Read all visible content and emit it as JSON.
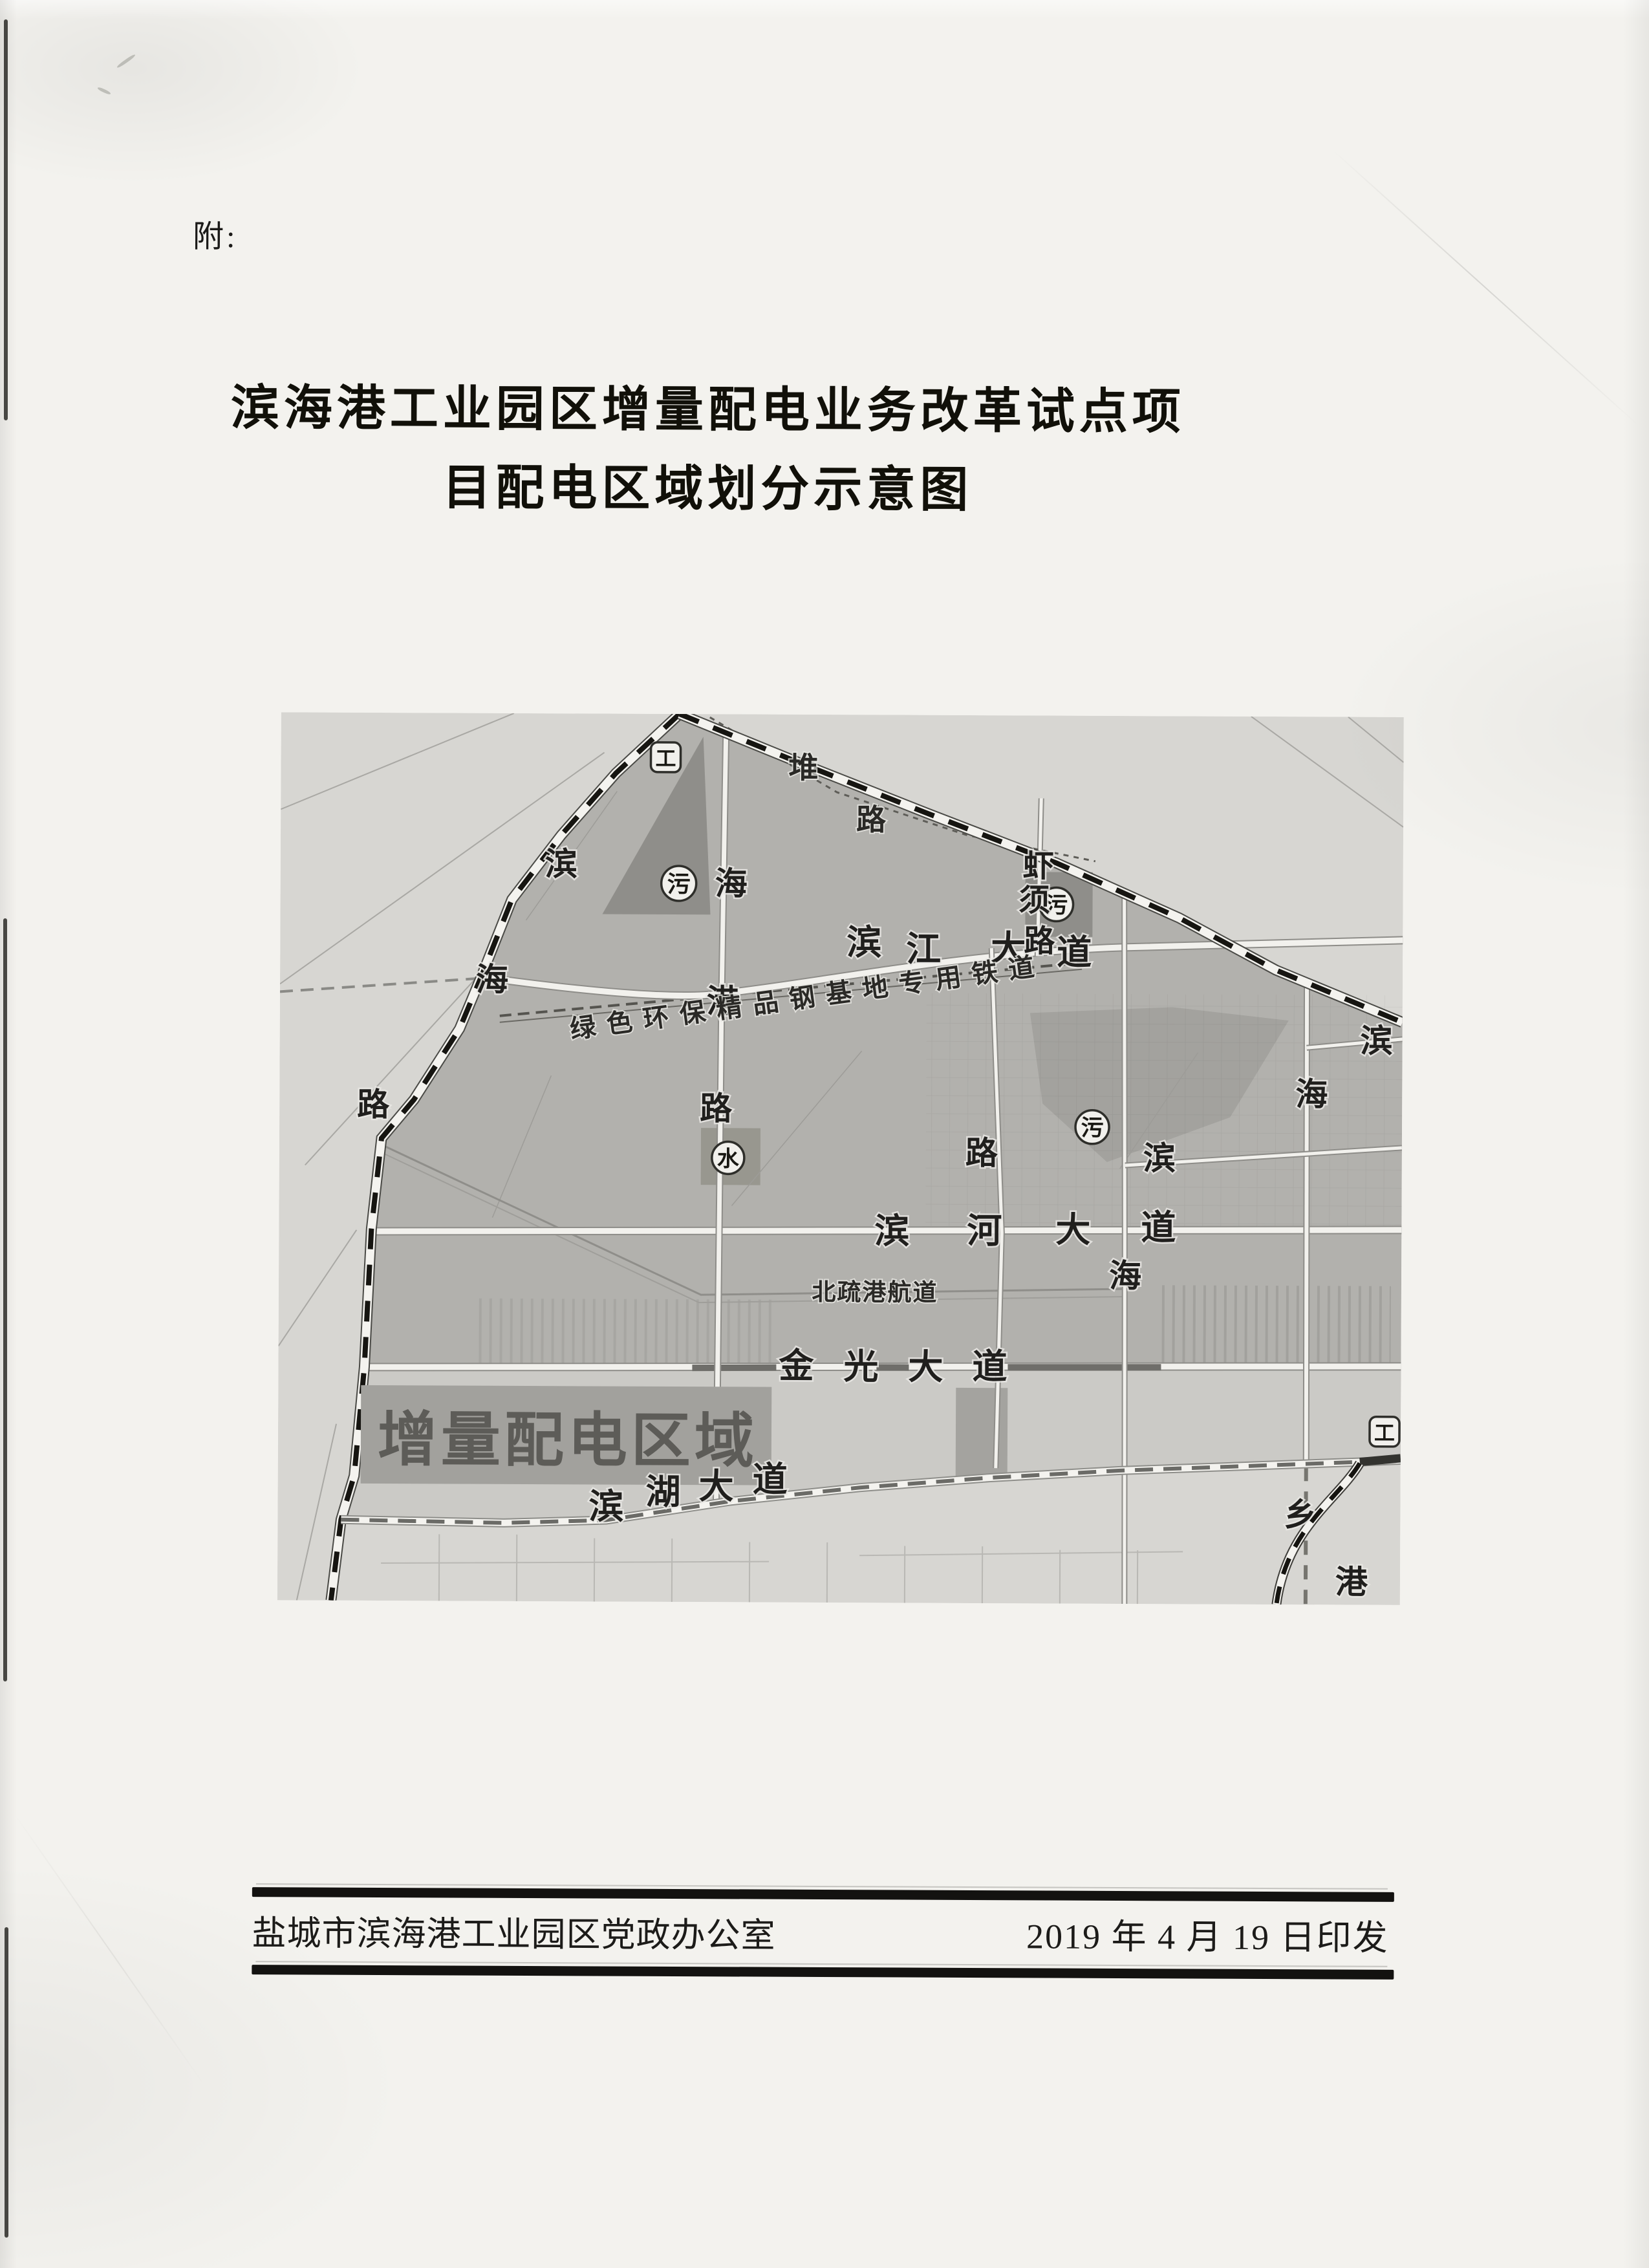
{
  "header": {
    "attachment_marker": "附:"
  },
  "title": {
    "line1": "滨海港工业园区增量配电业务改革试点项",
    "line2": "目配电区域划分示意图"
  },
  "map": {
    "area_label": "增量配电区域",
    "railway_label": "绿色环保精品钢基地专用铁道",
    "channel_label": "北疏港航道",
    "roads": {
      "binjiang_avenue": [
        "滨",
        "江",
        "大",
        "道"
      ],
      "binhe_avenue": [
        "滨",
        "河",
        "大",
        "道"
      ],
      "jinguang_avenue": [
        "金",
        "光",
        "大",
        "道"
      ],
      "binhu_avenue": [
        "滨",
        "湖",
        "大",
        "道"
      ],
      "haigang_road": [
        "海",
        "港",
        "路"
      ],
      "xiaxu_road": [
        "虾",
        "须",
        "路"
      ],
      "coastal_boundary_road": [
        "滨",
        "海",
        "路"
      ],
      "huaidui_road": [
        "堆",
        "路"
      ],
      "east_road": [
        "海",
        "乡",
        "港"
      ],
      "mid_hai": "海",
      "south_lu": "路",
      "stub_bin_mid": "滨",
      "stub_bin_right": "滨"
    },
    "badges": {
      "sewage": "污",
      "water": "水",
      "plant": "工"
    }
  },
  "footer": {
    "issuer": "盐城市滨海港工业园区党政办公室",
    "date": "2019 年 4 月 19 日印发"
  }
}
